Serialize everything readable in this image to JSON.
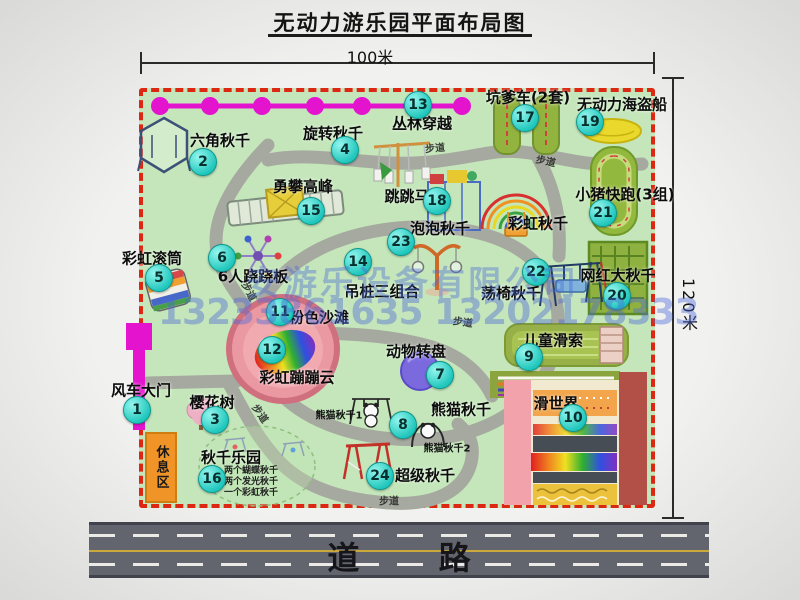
{
  "title": "无动力游乐园平面布局图",
  "dimensions": {
    "width_label": "100米",
    "height_label": "120米"
  },
  "watermark": {
    "company": "安游乐设备有限公司",
    "phones": "13233861635 13202178333"
  },
  "road": {
    "label": "道 路"
  },
  "rest_area_label": "休息区",
  "walkway_label": "步道",
  "attractions": [
    {
      "num": "1",
      "label": "风车大门"
    },
    {
      "num": "2",
      "label": "六角秋千"
    },
    {
      "num": "3",
      "label": "樱花树"
    },
    {
      "num": "4",
      "label": "旋转秋千"
    },
    {
      "num": "5",
      "label": "彩虹滚筒"
    },
    {
      "num": "6",
      "label": "6人跷跷板"
    },
    {
      "num": "7",
      "label": "动物转盘"
    },
    {
      "num": "8",
      "label": "熊猫秋千"
    },
    {
      "num": "9",
      "label": "儿童滑索"
    },
    {
      "num": "10",
      "label": "滑世界"
    },
    {
      "num": "11",
      "label": "粉色沙滩"
    },
    {
      "num": "12",
      "label": "彩虹蹦蹦云"
    },
    {
      "num": "13",
      "label": "丛林穿越"
    },
    {
      "num": "14",
      "label": "吊桩三组合"
    },
    {
      "num": "15",
      "label": "勇攀高峰"
    },
    {
      "num": "16",
      "label": "秋千乐园"
    },
    {
      "num": "17",
      "label": "坑爹车(2套)"
    },
    {
      "num": "18",
      "label": "跳跳马"
    },
    {
      "num": "19",
      "label": "无动力海盗船"
    },
    {
      "num": "20",
      "label": "网红大秋千"
    },
    {
      "num": "21",
      "label": "小猪快跑(3组)"
    },
    {
      "num": "22",
      "label": "荡椅秋千"
    },
    {
      "num": "23",
      "label": "泡泡秋千"
    },
    {
      "num": "24",
      "label": "超级秋千"
    },
    {
      "num": "",
      "label": "彩虹秋千"
    }
  ],
  "sub_labels": {
    "panda_swing_1": "熊猫秋千1",
    "panda_swing_2": "熊猫秋千2",
    "swing_park_notes": [
      "两个蝴蝶秋千",
      "两个发光秋千",
      "一个彩虹秋千"
    ]
  },
  "colors": {
    "map_green": "#c4e6ba",
    "border_red": "#dc2812",
    "badge_teal": "#20c8be",
    "gate_magenta": "#e414ce",
    "road_gray": "#62646e"
  }
}
